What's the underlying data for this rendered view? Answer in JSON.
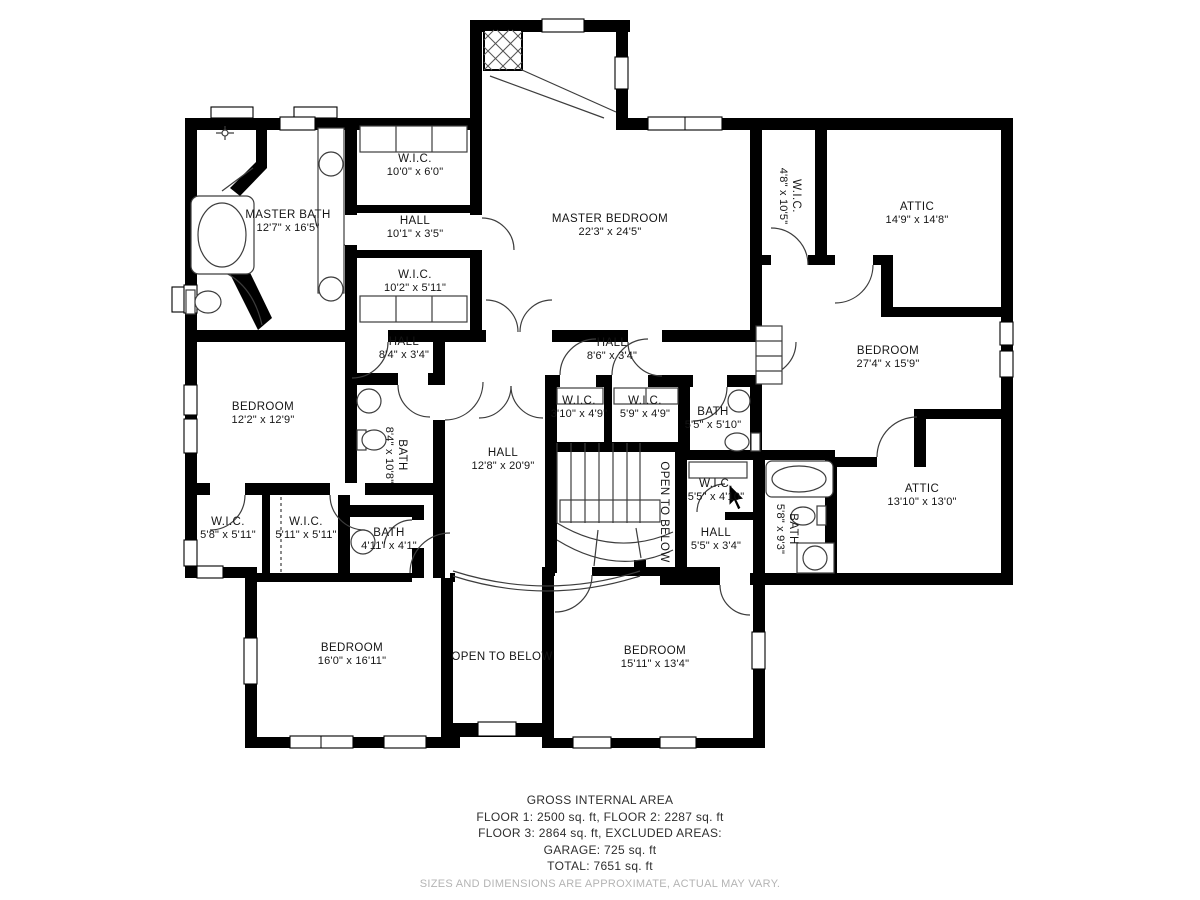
{
  "rooms": [
    {
      "name": "MASTER BATH",
      "dims": "12'7\" x 16'5\""
    },
    {
      "name": "W.I.C.",
      "dims": "10'0\" x 6'0\""
    },
    {
      "name": "HALL",
      "dims": "10'1\" x 3'5\""
    },
    {
      "name": "W.I.C.",
      "dims": "10'2\" x 5'11\""
    },
    {
      "name": "MASTER BEDROOM",
      "dims": "22'3\" x 24'5\""
    },
    {
      "name": "W.I.C.",
      "dims": "4'8\" x 10'5\""
    },
    {
      "name": "ATTIC",
      "dims": "14'9\" x 14'8\""
    },
    {
      "name": "BEDROOM",
      "dims": "27'4\" x 15'9\""
    },
    {
      "name": "HALL",
      "dims": "8'4\" x 3'4\""
    },
    {
      "name": "HALL",
      "dims": "8'6\" x 3'4\""
    },
    {
      "name": "BEDROOM",
      "dims": "12'2\" x 12'9\""
    },
    {
      "name": "BATH",
      "dims": "8'4\" x 10'8\""
    },
    {
      "name": "HALL",
      "dims": "12'8\" x 20'9\""
    },
    {
      "name": "W.I.C.",
      "dims": "3'10\" x 4'9\""
    },
    {
      "name": "W.I.C.",
      "dims": "5'9\" x 4'9\""
    },
    {
      "name": "BATH",
      "dims": "5'5\" x 5'10\""
    },
    {
      "name": "W.I.C.",
      "dims": "5'8\" x 5'11\""
    },
    {
      "name": "W.I.C.",
      "dims": "5'11\" x 5'11\""
    },
    {
      "name": "BATH",
      "dims": "4'11\" x 4'1\""
    },
    {
      "name": "W.I.C.",
      "dims": "5'5\" x 4'10\""
    },
    {
      "name": "HALL",
      "dims": "5'5\" x 3'4\""
    },
    {
      "name": "BATH",
      "dims": "5'8\" x 9'3\""
    },
    {
      "name": "ATTIC",
      "dims": "13'10\" x 13'0\""
    },
    {
      "name": "OPEN TO BELOW",
      "dims": ""
    },
    {
      "name": "BEDROOM",
      "dims": "16'0\" x 16'11\""
    },
    {
      "name": "OPEN TO BELOW",
      "dims": ""
    },
    {
      "name": "BEDROOM",
      "dims": "15'11\" x 13'4\""
    }
  ],
  "footer": {
    "title": "GROSS INTERNAL AREA",
    "line1": "FLOOR 1: 2500 sq. ft, FLOOR 2: 2287 sq. ft",
    "line2": "FLOOR 3: 2864 sq. ft, EXCLUDED AREAS:",
    "line3": "GARAGE: 725 sq. ft",
    "line4": "TOTAL: 7651 sq. ft",
    "disclaimer": "SIZES AND DIMENSIONS ARE APPROXIMATE, ACTUAL MAY VARY."
  }
}
